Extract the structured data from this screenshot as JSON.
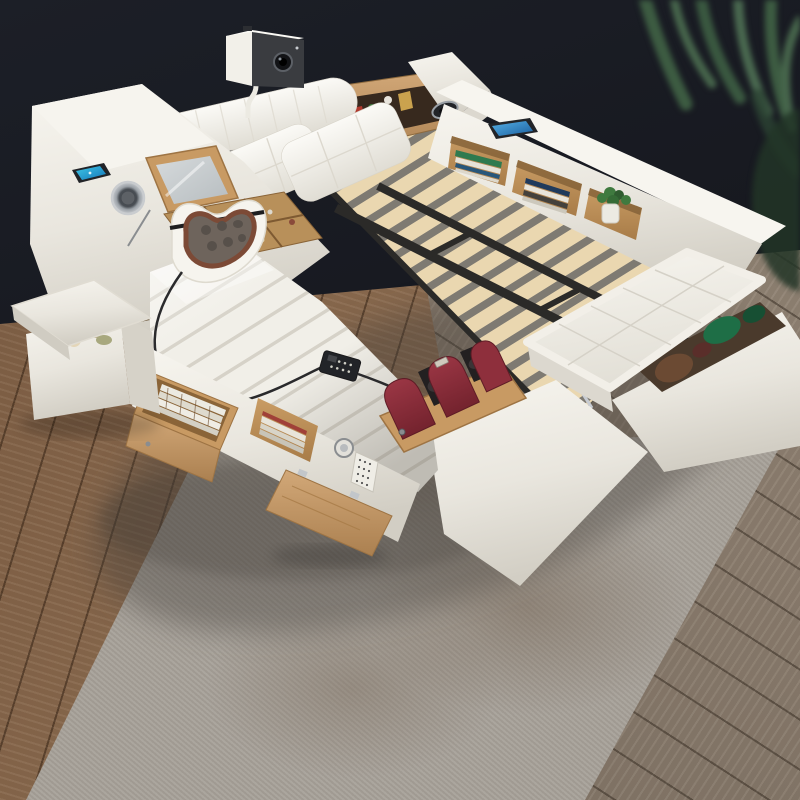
{
  "scene": {
    "type": "product-photo",
    "subject": "multifunctional smart storage bed",
    "setting": "dark wall with palm leaves, wood plank floor, mottled gray rug",
    "contents": [
      "arm-mounted projector above headboard",
      "white leather headboard with roll pillows and wooden book shelf",
      "left console with wireless-charging phone pad and two round speakers",
      "flip-up vanity mirror with wooden jewelry organizer",
      "white ribbed massage chaise with neck massage cushion and wired remote",
      "exposed wooden slat bed base on black metal frame",
      "right rail bookshelf with books, potted plant and tablet",
      "lift-top tufted storage bench with blankets inside",
      "open storage ottoman with blankets",
      "pull-out wooden drawer with magazines",
      "open niche with books and safe with dial and keypad",
      "fold-down wooden door",
      "dark-red wooden foot massager with black rollers"
    ]
  },
  "palette": {
    "wall": "#181a20",
    "leaf_dark": "#3d5c42",
    "leaf_light": "#4a6950",
    "floor_left": "#8a6a4e",
    "floor_right": "#8b7d6e",
    "rug": "#a7a199",
    "bed_white": "#f2f0ea",
    "bed_shade": "#d9d5cc",
    "wood": "#c89a63",
    "wood_mid": "#b8905a",
    "wood_dark": "#9e7444",
    "slat": "#ead7b0",
    "slat_gap": "#7e7a72",
    "metal_frame": "#2b2a28",
    "massager_red": "#8e2f3c",
    "roller_black": "#232021",
    "cushion_gray": "#6e645c",
    "cushion_trim": "#7c4a36",
    "screen_blue": "#2a8fd0",
    "plant_green": "#3f7a3f",
    "speaker_metal": "#c9cccf",
    "device_dark": "#222428",
    "projector_front": "#3a3c40",
    "storage_interior": "#4a3a2c",
    "blanket_green": "#1e6e46",
    "blanket_brown": "#6b4a33"
  }
}
